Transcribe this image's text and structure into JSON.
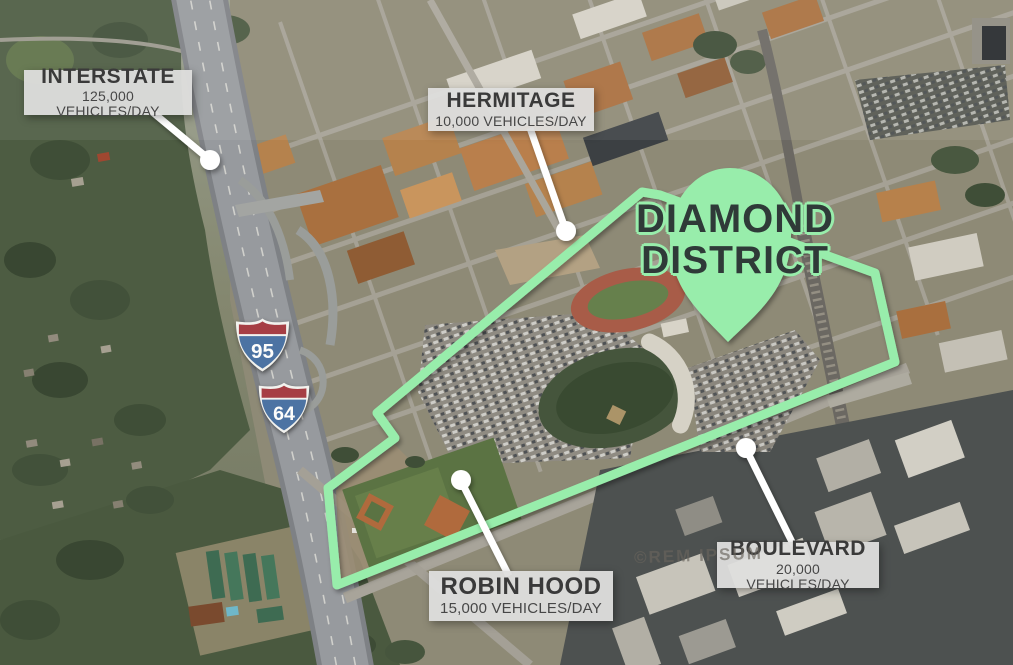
{
  "district": {
    "title_line1": "DIAMOND",
    "title_line2": "DISTRICT"
  },
  "callouts": {
    "interstate": {
      "title": "INTERSTATE",
      "subtitle": "125,000 VEHICLES/DAY"
    },
    "hermitage": {
      "title": "HERMITAGE",
      "subtitle": "10,000 VEHICLES/DAY"
    },
    "robin_hood": {
      "title": "ROBIN HOOD",
      "subtitle": "15,000 VEHICLES/DAY"
    },
    "boulevard": {
      "title": "BOULEVARD",
      "subtitle": "20,000 VEHICLES/DAY"
    }
  },
  "highway_shields": {
    "i95": "95",
    "i64": "64"
  },
  "watermark": "©REM IPSUM",
  "colors": {
    "district_green": "#98EDAB",
    "label_box": "#DEDEDD",
    "label_text": "#3A3A3A",
    "title_text": "#2F3A38",
    "shield_red": "#A63E44",
    "shield_blue": "#4C73A3",
    "callout_line": "#FFFFFF"
  }
}
